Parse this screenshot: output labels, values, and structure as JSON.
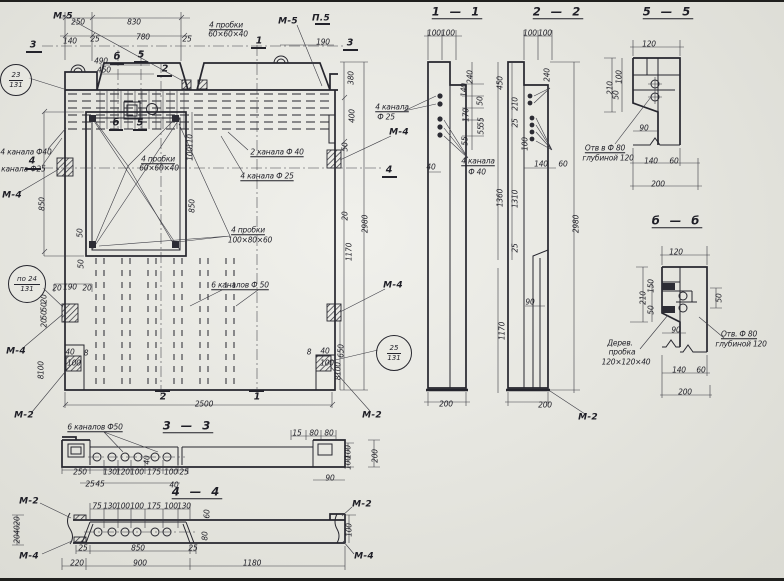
{
  "meta": {
    "kind": "reinforced concrete panel working drawing",
    "language": "ru"
  },
  "colors": {
    "paper": "#e9e9e2",
    "ink": "#26262e"
  },
  "section_titles": [
    {
      "t": "1 — 1",
      "x": 457,
      "y": 12
    },
    {
      "t": "2 — 2",
      "x": 558,
      "y": 12
    },
    {
      "t": "5 — 5",
      "x": 668,
      "y": 12
    },
    {
      "t": "б — б",
      "x": 677,
      "y": 221
    },
    {
      "t": "3 — 3",
      "x": 188,
      "y": 426
    },
    {
      "t": "4 — 4",
      "x": 197,
      "y": 492
    }
  ],
  "ref_circles": [
    {
      "top": "23",
      "bot": "131",
      "x": 16,
      "y": 80,
      "r": 15
    },
    {
      "top": "по 24",
      "bot": "131",
      "x": 27,
      "y": 284,
      "r": 18
    },
    {
      "top": "25",
      "bot": "131",
      "x": 394,
      "y": 353,
      "r": 17
    }
  ],
  "labels": [
    {
      "t": "М-5",
      "x": 63,
      "y": 17,
      "n": "weld-mark"
    },
    {
      "t": "М-5",
      "x": 288,
      "y": 22,
      "n": "weld-mark"
    },
    {
      "t": "П.5",
      "x": 321,
      "y": 19,
      "n": "weld-mark"
    },
    {
      "t": "М-4",
      "x": 12,
      "y": 196,
      "n": "weld-mark"
    },
    {
      "t": "М-4",
      "x": 16,
      "y": 352,
      "n": "weld-mark"
    },
    {
      "t": "М-4",
      "x": 399,
      "y": 133,
      "n": "weld-mark"
    },
    {
      "t": "М-4",
      "x": 393,
      "y": 286,
      "n": "weld-mark"
    },
    {
      "t": "М-2",
      "x": 24,
      "y": 416,
      "n": "weld-mark"
    },
    {
      "t": "М-2",
      "x": 372,
      "y": 416,
      "n": "weld-mark"
    },
    {
      "t": "М-2",
      "x": 588,
      "y": 418,
      "n": "weld-mark"
    },
    {
      "t": "М-2",
      "x": 29,
      "y": 502,
      "n": "weld-mark"
    },
    {
      "t": "М-4",
      "x": 29,
      "y": 557,
      "n": "weld-mark"
    },
    {
      "t": "М-2",
      "x": 362,
      "y": 505,
      "n": "weld-mark"
    },
    {
      "t": "М-4",
      "x": 364,
      "y": 557,
      "n": "weld-mark"
    },
    {
      "t": "3",
      "x": 33,
      "y": 45,
      "n": "cut-mark"
    },
    {
      "t": "3",
      "x": 350,
      "y": 43,
      "n": "cut-mark"
    },
    {
      "t": "4",
      "x": 32,
      "y": 161,
      "n": "cut-mark"
    },
    {
      "t": "4",
      "x": 389,
      "y": 170,
      "n": "cut-mark"
    },
    {
      "t": "б",
      "x": 117,
      "y": 57,
      "n": "cut-mark"
    },
    {
      "t": "5",
      "x": 141,
      "y": 55,
      "n": "cut-mark"
    },
    {
      "t": "б",
      "x": 116,
      "y": 123,
      "n": "cut-mark"
    },
    {
      "t": "5",
      "x": 140,
      "y": 123,
      "n": "cut-mark"
    },
    {
      "t": "2",
      "x": 165,
      "y": 69,
      "n": "cut-mark"
    },
    {
      "t": "2",
      "x": 163,
      "y": 397,
      "n": "cut-mark"
    },
    {
      "t": "1",
      "x": 259,
      "y": 41,
      "n": "cut-mark"
    },
    {
      "t": "1",
      "x": 257,
      "y": 397,
      "n": "cut-mark"
    },
    {
      "t": "4 пробки",
      "x": 226,
      "y": 25,
      "u": 1,
      "n": "callout"
    },
    {
      "t": "60×60×40",
      "x": 228,
      "y": 34,
      "n": "callout"
    },
    {
      "t": "4 пробки",
      "x": 158,
      "y": 159,
      "u": 1,
      "n": "callout"
    },
    {
      "t": "60×60×40",
      "x": 159,
      "y": 168,
      "n": "callout"
    },
    {
      "t": "4 пробки",
      "x": 248,
      "y": 230,
      "u": 1,
      "n": "callout"
    },
    {
      "t": "100×80×60",
      "x": 250,
      "y": 240,
      "n": "callout"
    },
    {
      "t": "2 канала Ф 40",
      "x": 277,
      "y": 152,
      "u": 1,
      "n": "callout"
    },
    {
      "t": "4 канала Ф 25",
      "x": 267,
      "y": 176,
      "u": 1,
      "n": "callout"
    },
    {
      "t": "4 канала Ф40",
      "x": 26,
      "y": 152,
      "n": "callout"
    },
    {
      "t": "4 канала Ф25",
      "x": 20,
      "y": 169,
      "n": "callout"
    },
    {
      "t": "6 каналов Ф 50",
      "x": 240,
      "y": 285,
      "u": 1,
      "n": "callout"
    },
    {
      "t": "6 каналов Ф50",
      "x": 95,
      "y": 427,
      "u": 1,
      "n": "callout"
    },
    {
      "t": "4 канала",
      "x": 392,
      "y": 107,
      "u": 1,
      "n": "callout"
    },
    {
      "t": "Ф 25",
      "x": 386,
      "y": 117,
      "n": "callout"
    },
    {
      "t": "4 канала",
      "x": 478,
      "y": 161,
      "u": 1,
      "n": "callout"
    },
    {
      "t": "Ф 40",
      "x": 477,
      "y": 172,
      "n": "callout"
    },
    {
      "t": "Отв в Ф 80",
      "x": 605,
      "y": 148,
      "u": 1,
      "n": "callout"
    },
    {
      "t": "глубиной 120",
      "x": 608,
      "y": 158,
      "n": "callout"
    },
    {
      "t": "Отв. Ф 80",
      "x": 739,
      "y": 334,
      "u": 1,
      "n": "callout"
    },
    {
      "t": "глубиной 120",
      "x": 741,
      "y": 344,
      "n": "callout"
    },
    {
      "t": "Дерев.",
      "x": 620,
      "y": 343,
      "n": "callout"
    },
    {
      "t": "пробка",
      "x": 622,
      "y": 352,
      "n": "callout"
    },
    {
      "t": "120×120×40",
      "x": 626,
      "y": 362,
      "n": "callout"
    },
    {
      "t": "250",
      "x": 78,
      "y": 22
    },
    {
      "t": "830",
      "x": 134,
      "y": 22
    },
    {
      "t": "140",
      "x": 70,
      "y": 41
    },
    {
      "t": "25",
      "x": 95,
      "y": 39
    },
    {
      "t": "780",
      "x": 143,
      "y": 37
    },
    {
      "t": "25",
      "x": 187,
      "y": 39
    },
    {
      "t": "490",
      "x": 101,
      "y": 61
    },
    {
      "t": "450",
      "x": 104,
      "y": 70
    },
    {
      "t": "190",
      "x": 323,
      "y": 42
    },
    {
      "t": "380",
      "x": 351,
      "y": 78,
      "r": 1
    },
    {
      "t": "400",
      "x": 352,
      "y": 116,
      "r": 1
    },
    {
      "t": "50",
      "x": 345,
      "y": 147,
      "r": 1
    },
    {
      "t": "20",
      "x": 345,
      "y": 216,
      "r": 1
    },
    {
      "t": "1170",
      "x": 349,
      "y": 252,
      "r": 1
    },
    {
      "t": "2980",
      "x": 365,
      "y": 224,
      "r": 1
    },
    {
      "t": "650",
      "x": 341,
      "y": 351,
      "r": 1
    },
    {
      "t": "850",
      "x": 42,
      "y": 204,
      "r": 1
    },
    {
      "t": "850",
      "x": 192,
      "y": 206,
      "r": 1
    },
    {
      "t": "110",
      "x": 190,
      "y": 141,
      "r": 1
    },
    {
      "t": "100",
      "x": 190,
      "y": 154,
      "r": 1
    },
    {
      "t": "50",
      "x": 80,
      "y": 233,
      "r": 1
    },
    {
      "t": "50",
      "x": 81,
      "y": 264,
      "r": 1
    },
    {
      "t": "20",
      "x": 57,
      "y": 288
    },
    {
      "t": "190",
      "x": 70,
      "y": 287
    },
    {
      "t": "20",
      "x": 87,
      "y": 288
    },
    {
      "t": "20",
      "x": 44,
      "y": 299,
      "r": 1
    },
    {
      "t": "50",
      "x": 44,
      "y": 307,
      "r": 1
    },
    {
      "t": "50",
      "x": 44,
      "y": 315,
      "r": 1
    },
    {
      "t": "20",
      "x": 44,
      "y": 323,
      "r": 1
    },
    {
      "t": "40",
      "x": 70,
      "y": 352
    },
    {
      "t": "8",
      "x": 86,
      "y": 353
    },
    {
      "t": "100",
      "x": 74,
      "y": 363
    },
    {
      "t": "100",
      "x": 41,
      "y": 368,
      "r": 1
    },
    {
      "t": "8",
      "x": 41,
      "y": 377,
      "r": 1
    },
    {
      "t": "8",
      "x": 309,
      "y": 352
    },
    {
      "t": "40",
      "x": 325,
      "y": 351
    },
    {
      "t": "100",
      "x": 327,
      "y": 363
    },
    {
      "t": "100",
      "x": 338,
      "y": 369,
      "r": 1
    },
    {
      "t": "8",
      "x": 338,
      "y": 378,
      "r": 1
    },
    {
      "t": "2500",
      "x": 204,
      "y": 404
    },
    {
      "t": "100",
      "x": 434,
      "y": 33
    },
    {
      "t": "100",
      "x": 448,
      "y": 33
    },
    {
      "t": "240",
      "x": 470,
      "y": 77,
      "r": 1
    },
    {
      "t": "140",
      "x": 464,
      "y": 90,
      "r": 1
    },
    {
      "t": "50",
      "x": 480,
      "y": 101,
      "r": 1
    },
    {
      "t": "170",
      "x": 466,
      "y": 115,
      "r": 1
    },
    {
      "t": "55",
      "x": 481,
      "y": 122,
      "r": 1
    },
    {
      "t": "55",
      "x": 481,
      "y": 130,
      "r": 1
    },
    {
      "t": "55",
      "x": 465,
      "y": 141,
      "r": 1
    },
    {
      "t": "40",
      "x": 431,
      "y": 167
    },
    {
      "t": "200",
      "x": 446,
      "y": 404
    },
    {
      "t": "100",
      "x": 530,
      "y": 33
    },
    {
      "t": "100",
      "x": 545,
      "y": 33
    },
    {
      "t": "450",
      "x": 500,
      "y": 83,
      "r": 1
    },
    {
      "t": "240",
      "x": 547,
      "y": 75,
      "r": 1
    },
    {
      "t": "210",
      "x": 515,
      "y": 104,
      "r": 1
    },
    {
      "t": "25",
      "x": 515,
      "y": 123,
      "r": 1
    },
    {
      "t": "100",
      "x": 525,
      "y": 144,
      "r": 1
    },
    {
      "t": "140",
      "x": 541,
      "y": 164
    },
    {
      "t": "60",
      "x": 563,
      "y": 164
    },
    {
      "t": "1360",
      "x": 500,
      "y": 198,
      "r": 1
    },
    {
      "t": "1310",
      "x": 515,
      "y": 199,
      "r": 1
    },
    {
      "t": "25",
      "x": 515,
      "y": 248,
      "r": 1
    },
    {
      "t": "90",
      "x": 530,
      "y": 302
    },
    {
      "t": "1170",
      "x": 502,
      "y": 331,
      "r": 1
    },
    {
      "t": "2980",
      "x": 576,
      "y": 224,
      "r": 1
    },
    {
      "t": "200",
      "x": 545,
      "y": 405
    },
    {
      "t": "120",
      "x": 649,
      "y": 44
    },
    {
      "t": "100",
      "x": 619,
      "y": 77,
      "r": 1
    },
    {
      "t": "210",
      "x": 610,
      "y": 88,
      "r": 1
    },
    {
      "t": "50",
      "x": 616,
      "y": 95,
      "r": 1
    },
    {
      "t": "90",
      "x": 644,
      "y": 128
    },
    {
      "t": "140",
      "x": 651,
      "y": 161
    },
    {
      "t": "60",
      "x": 674,
      "y": 161
    },
    {
      "t": "200",
      "x": 658,
      "y": 184
    },
    {
      "t": "120",
      "x": 676,
      "y": 252
    },
    {
      "t": "150",
      "x": 651,
      "y": 286,
      "r": 1
    },
    {
      "t": "210",
      "x": 643,
      "y": 298,
      "r": 1
    },
    {
      "t": "50",
      "x": 651,
      "y": 310,
      "r": 1
    },
    {
      "t": "50",
      "x": 719,
      "y": 298,
      "r": 1
    },
    {
      "t": "90",
      "x": 676,
      "y": 330
    },
    {
      "t": "140",
      "x": 679,
      "y": 370
    },
    {
      "t": "60",
      "x": 701,
      "y": 370
    },
    {
      "t": "200",
      "x": 685,
      "y": 392
    },
    {
      "t": "40",
      "x": 147,
      "y": 460,
      "r": 1
    },
    {
      "t": "250",
      "x": 80,
      "y": 472
    },
    {
      "t": "130",
      "x": 110,
      "y": 472
    },
    {
      "t": "120",
      "x": 123,
      "y": 472
    },
    {
      "t": "100",
      "x": 137,
      "y": 472
    },
    {
      "t": "175",
      "x": 154,
      "y": 472
    },
    {
      "t": "100",
      "x": 171,
      "y": 472
    },
    {
      "t": "25",
      "x": 184,
      "y": 472
    },
    {
      "t": "25",
      "x": 90,
      "y": 484
    },
    {
      "t": "45",
      "x": 100,
      "y": 484
    },
    {
      "t": "40",
      "x": 174,
      "y": 485
    },
    {
      "t": "15",
      "x": 297,
      "y": 433
    },
    {
      "t": "80",
      "x": 314,
      "y": 433
    },
    {
      "t": "80",
      "x": 329,
      "y": 433
    },
    {
      "t": "90",
      "x": 330,
      "y": 478
    },
    {
      "t": "100",
      "x": 348,
      "y": 452,
      "r": 1
    },
    {
      "t": "100",
      "x": 348,
      "y": 463,
      "r": 1
    },
    {
      "t": "200",
      "x": 375,
      "y": 456,
      "r": 1
    },
    {
      "t": "75",
      "x": 97,
      "y": 506
    },
    {
      "t": "130",
      "x": 110,
      "y": 506
    },
    {
      "t": "100",
      "x": 123,
      "y": 506
    },
    {
      "t": "100",
      "x": 137,
      "y": 506
    },
    {
      "t": "175",
      "x": 154,
      "y": 506
    },
    {
      "t": "100",
      "x": 171,
      "y": 506
    },
    {
      "t": "130",
      "x": 184,
      "y": 506
    },
    {
      "t": "60",
      "x": 207,
      "y": 514,
      "r": 1
    },
    {
      "t": "80",
      "x": 205,
      "y": 536,
      "r": 1
    },
    {
      "t": "20",
      "x": 17,
      "y": 521,
      "r": 1
    },
    {
      "t": "40",
      "x": 17,
      "y": 530,
      "r": 1
    },
    {
      "t": "20",
      "x": 17,
      "y": 539,
      "r": 1
    },
    {
      "t": "25",
      "x": 83,
      "y": 548
    },
    {
      "t": "850",
      "x": 138,
      "y": 548
    },
    {
      "t": "25",
      "x": 193,
      "y": 548
    },
    {
      "t": "220",
      "x": 77,
      "y": 563
    },
    {
      "t": "900",
      "x": 140,
      "y": 563
    },
    {
      "t": "1180",
      "x": 252,
      "y": 563
    },
    {
      "t": "100",
      "x": 349,
      "y": 530,
      "r": 1
    }
  ]
}
